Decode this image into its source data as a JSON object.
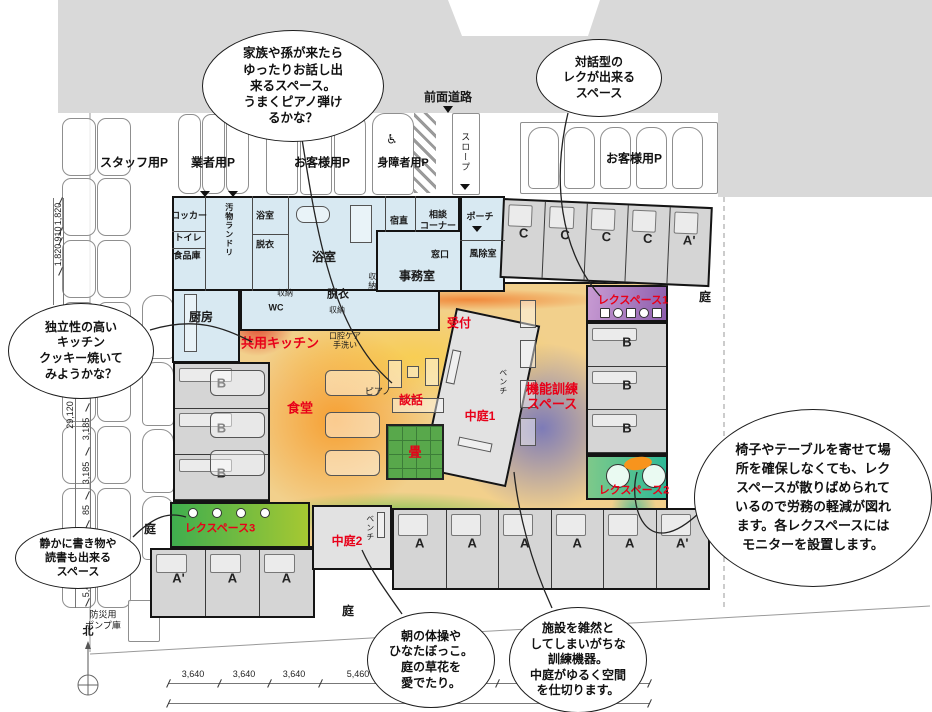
{
  "site": {
    "road": "前面道路",
    "north": "北",
    "slope": "スロープ",
    "pump": "防災用\nポンプ庫",
    "garden": "庭"
  },
  "parking": {
    "staff": "スタッフ用P",
    "vendor": "業者用P",
    "guest": "お客様用P",
    "disabled": "身障者用P",
    "guest_right": "お客様用P",
    "wheelchair_icon": "♿"
  },
  "letters": {
    "a": "A",
    "ad": "A'",
    "b": "B",
    "c": "C"
  },
  "rooms": {
    "locker": "ロッカー",
    "toilet": "トイレ",
    "pantry": "食品庫",
    "laundry": "汚物ランドリ",
    "bath": "浴室",
    "night": "宿直",
    "consult": "相談\nコーナー",
    "porch": "ポーチ",
    "counter": "窓口",
    "windbreak": "風除室",
    "office": "事務室",
    "storage": "収納",
    "wc": "WC",
    "undress": "脱衣",
    "kitchen": "厨房",
    "oral": "口腔ケア\n手洗い",
    "piano": "ピアノ",
    "bench": "ベンチ"
  },
  "zones": {
    "shared_kitchen": "共用キッチン",
    "reception": "受付",
    "dining": "食堂",
    "chat": "談話",
    "tatami": "畳",
    "courtyard1": "中庭1",
    "courtyard2": "中庭2",
    "training": "機能訓練\nスペース",
    "rec1": "レクスペース1",
    "rec2": "レクスペース2",
    "rec3": "レクスペース3"
  },
  "bubbles": {
    "family": "家族や孫が来たら\nゆったりお話し出\n来るスペース。\nうまくピアノ弾け\nるかな？",
    "dialog": "対話型の\nレクが出来る\nスペース",
    "kitchen": "独立性の高い\nキッチン\nクッキー焼いて\nみようかな？",
    "quiet": "静かに書き物や\n読書も出来る\nスペース",
    "rec": "椅子やテーブルを寄せて場\n所を確保しなくても、レク\nスペースが散りばめられて\nいるので労務の軽減が図れ\nます。各レクスペースには\nモニターを設置します。",
    "morning": "朝の体操や\nひなたぼっこ。\n庭の草花を\n愛でたり。",
    "equipment": "施設を雑然と\nしてしまいがちな\n訓練機器。\n中庭がゆるく空間\nを仕切ります。"
  },
  "dims": {
    "tl": [
      "1,820",
      "910",
      "1,820"
    ],
    "left_total": "29,120",
    "left": [
      "3,185",
      "3,185",
      "3,185",
      "85",
      "5,460"
    ],
    "bottom": [
      "3,640",
      "3,640",
      "3,640",
      "5,460",
      "3,640",
      "3,640",
      "3,640",
      "3,640",
      "3,640"
    ],
    "bottom_total": "38,220"
  }
}
